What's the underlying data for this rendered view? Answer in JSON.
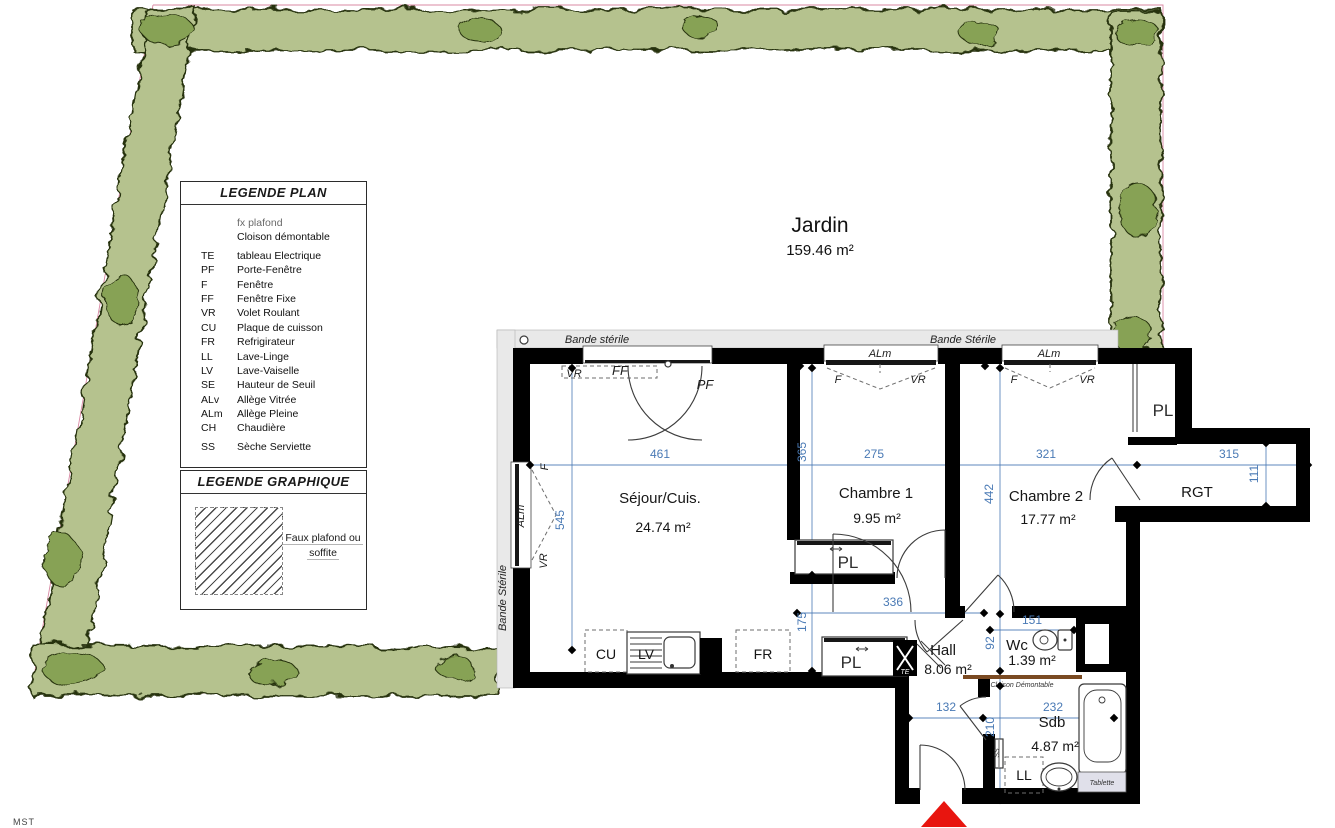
{
  "colors": {
    "dim-blue": "#4a7ab5",
    "hedge-light": "#b5c28e",
    "hedge-dark": "#87a254",
    "accent-red": "#e8150f",
    "partition-brown": "#7a4a22",
    "band-grey": "#e9e9e9",
    "wall-black": "#000000"
  },
  "legend_plan": {
    "title": "LEGENDE PLAN",
    "items": [
      {
        "abbr": "",
        "label": "fx plafond"
      },
      {
        "abbr": "",
        "label": "Cloison démontable"
      },
      {
        "abbr": "TE",
        "label": "tableau Electrique"
      },
      {
        "abbr": "PF",
        "label": "Porte-Fenêtre"
      },
      {
        "abbr": "F",
        "label": "Fenêtre"
      },
      {
        "abbr": "FF",
        "label": "Fenêtre Fixe"
      },
      {
        "abbr": "VR",
        "label": "Volet Roulant"
      },
      {
        "abbr": "CU",
        "label": "Plaque de cuisson"
      },
      {
        "abbr": "FR",
        "label": "Refrigirateur"
      },
      {
        "abbr": "LL",
        "label": "Lave-Linge"
      },
      {
        "abbr": "LV",
        "label": "Lave-Vaiselle"
      },
      {
        "abbr": "SE",
        "label": "Hauteur de Seuil"
      },
      {
        "abbr": "ALv",
        "label": "Allège Vitrée"
      },
      {
        "abbr": "ALm",
        "label": "Allège Pleine"
      },
      {
        "abbr": "CH",
        "label": "Chaudière"
      },
      {
        "abbr": "SS",
        "label": "Sèche Serviette"
      }
    ]
  },
  "legend_graphique": {
    "title": "LEGENDE GRAPHIQUE",
    "label_line1": "Faux plafond ou",
    "label_line2": "soffite"
  },
  "garden": {
    "name": "Jardin",
    "area": "159.46 m²"
  },
  "bands": {
    "top_left": "Bande stérile",
    "top_right": "Bande Stérile",
    "left": "Bande Stérile"
  },
  "rooms": {
    "sejour": {
      "name": "Séjour/Cuis.",
      "area": "24.74 m²"
    },
    "chambre1": {
      "name": "Chambre 1",
      "area": "9.95 m²"
    },
    "chambre2": {
      "name": "Chambre 2",
      "area": "17.77 m²"
    },
    "hall": {
      "name": "Hall",
      "area": "8.06 m²"
    },
    "wc": {
      "name": "Wc",
      "area": "1.39 m²"
    },
    "sdb": {
      "name": "Sdb",
      "area": "4.87 m²"
    },
    "rgt": {
      "name": "RGT"
    }
  },
  "labels": {
    "pl": "PL",
    "vr": "VR",
    "ff": "FF",
    "pf": "PF",
    "f": "F",
    "alm": "ALm",
    "cu": "CU",
    "lv": "LV",
    "fr": "FR",
    "ll": "LL",
    "te": "TE",
    "ss": "SS",
    "tablette": "Tablette",
    "cloison": "Cloison Démontable"
  },
  "dims": {
    "d461": "461",
    "d545": "545",
    "d365": "365",
    "d275": "275",
    "d442": "442",
    "d321": "321",
    "d315": "315",
    "d111": "111",
    "d336": "336",
    "d175": "175",
    "d151": "151",
    "d92": "92",
    "d132": "132",
    "d232": "232",
    "d210": "210"
  },
  "misc": {
    "edge_label": "MST"
  }
}
